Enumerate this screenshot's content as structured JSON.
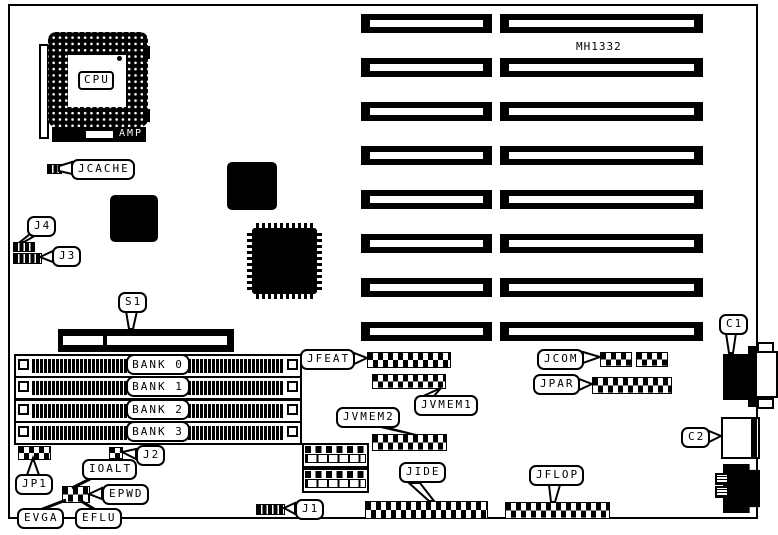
{
  "board": {
    "model": "MH1332"
  },
  "cpu": {
    "label": "CPU",
    "brand": "AMP"
  },
  "memory_banks": [
    "BANK 0",
    "BANK 1",
    "BANK 2",
    "BANK 3"
  ],
  "labels": {
    "jcache": "JCACHE",
    "j4": "J4",
    "j3": "J3",
    "s1": "S1",
    "jp1": "JP1",
    "j2": "J2",
    "ioalt": "IOALT",
    "epwd": "EPWD",
    "evga": "EVGA",
    "eflu": "EFLU",
    "j1": "J1",
    "jfeat": "JFEAT",
    "jvmem1": "JVMEM1",
    "jvmem2": "JVMEM2",
    "jide": "JIDE",
    "jflop": "JFLOP",
    "jcom": "JCOM",
    "jpar": "JPAR",
    "c1": "C1",
    "c2": "C2"
  },
  "colors": {
    "ink": "#000000",
    "paper": "#ffffff"
  }
}
